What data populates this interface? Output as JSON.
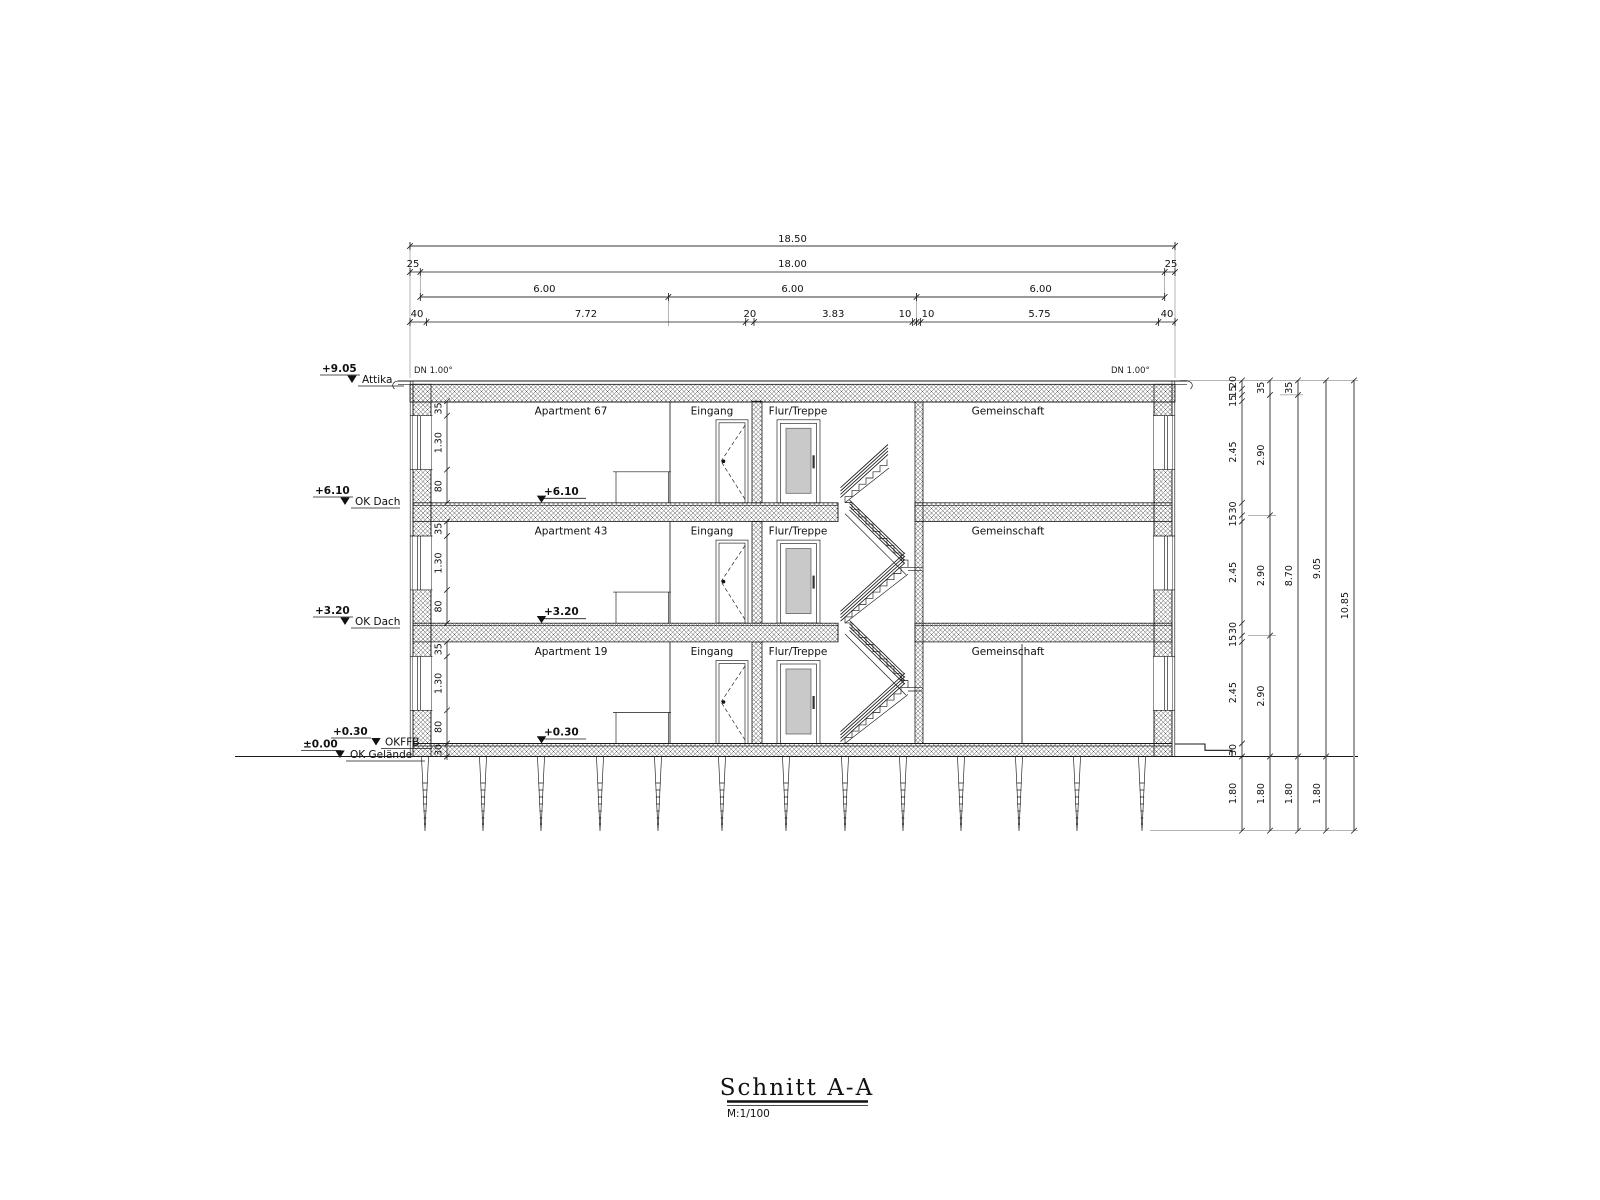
{
  "drawing": {
    "title": "Schnitt A-A",
    "scale_label": "M:1/100"
  },
  "top_dims": {
    "total": "18.50",
    "row2": [
      "25",
      "18.00",
      "25"
    ],
    "row3": [
      "6.00",
      "6.00",
      "6.00"
    ],
    "row4": [
      "40",
      "7.72",
      "20",
      "3.83",
      "10",
      "10",
      "5.75",
      "40"
    ]
  },
  "roof": {
    "slope_left": "DN 1.00°",
    "slope_right": "DN 1.00°"
  },
  "level_markers": {
    "attika": {
      "value": "+9.05",
      "label": "Attika"
    },
    "ok_dach_upper": {
      "value": "+6.10",
      "label": "OK Dach"
    },
    "ok_dach_lower": {
      "value": "+3.20",
      "label": "OK Dach"
    },
    "okffb": {
      "value": "+0.30",
      "label": "OKFFB"
    },
    "ok_gelaende": {
      "value": "±0.00",
      "label": "OK Gelände"
    }
  },
  "floor_markers": {
    "f3": "+6.10",
    "f2": "+3.20",
    "f1": "+0.30"
  },
  "rooms": {
    "apartments": [
      "Apartment 67",
      "Apartment 43",
      "Apartment 19"
    ],
    "entry": "Eingang",
    "stair_hall": "Flur/Treppe",
    "common": "Gemeinschaft"
  },
  "wall_chain": {
    "labels": [
      "35",
      "1.30",
      "80"
    ],
    "base": "30"
  },
  "right_chains": {
    "chain1": [
      "20",
      "15",
      "15",
      "2.45",
      "30",
      "15",
      "2.45",
      "30",
      "15",
      "2.45",
      "30",
      "1.80"
    ],
    "chain2": [
      "35",
      "2.90",
      "2.90",
      "2.90",
      "1.80"
    ],
    "chain3": [
      "35",
      "8.70",
      "1.80"
    ],
    "chain4": [
      "9.05",
      "1.80"
    ],
    "chain5": [
      "10.85"
    ]
  }
}
